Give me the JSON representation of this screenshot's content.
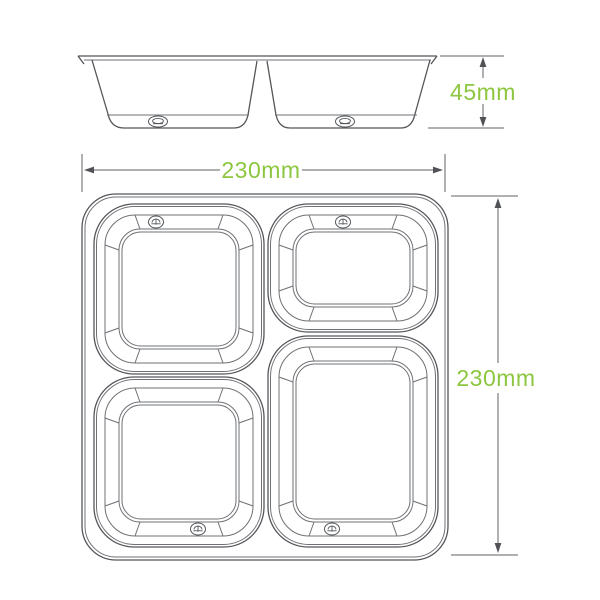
{
  "diagram": {
    "side_view": {
      "height_label": "45mm"
    },
    "top_view": {
      "width_label": "230mm",
      "length_label": "230mm"
    },
    "colors": {
      "line_gray": "#54565a",
      "dimension_green": "#8dc63f",
      "background": "#ffffff"
    }
  }
}
